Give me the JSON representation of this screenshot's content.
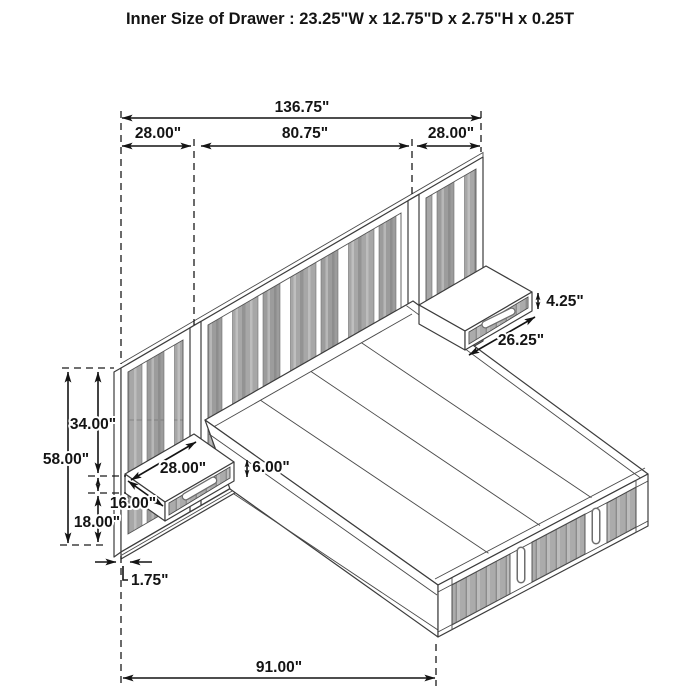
{
  "title": "Inner Size of Drawer : 23.25\"W x 12.75\"D x 2.75\"H x 0.25T",
  "dims": {
    "total_width": "136.75\"",
    "left_section": "28.00\"",
    "center_section": "80.75\"",
    "right_section": "28.00\"",
    "right_drawer_height": "4.25\"",
    "right_drawer_width": "26.25\"",
    "upper_height": "34.00\"",
    "total_height": "58.00\"",
    "shelf_width": "28.00\"",
    "shelf_rise": "6.00\"",
    "shelf_depth": "16.00\"",
    "lower_height": "18.00\"",
    "panel_thickness": "1.75\"",
    "bed_depth": "91.00\""
  }
}
